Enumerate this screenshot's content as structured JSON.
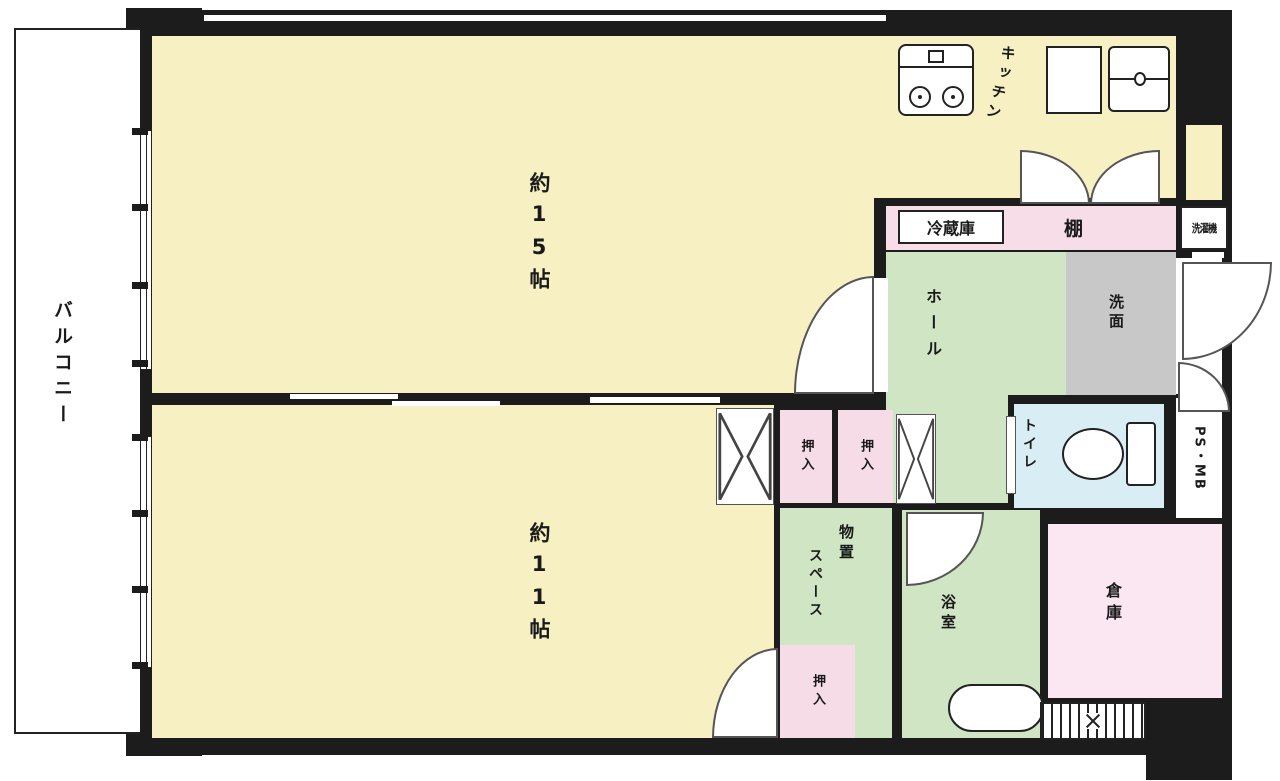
{
  "floor_plan": {
    "balcony_label": "バルコニー",
    "living_label": "約15帖",
    "bedroom_label": "約11帖",
    "kitchen_label": "キッチン",
    "fridge_label": "冷蔵庫",
    "shelf_label": "棚",
    "washer_label": "洗濯機",
    "hall_label": "ホール",
    "washroom_label": "洗面",
    "toilet_label": "トイレ",
    "ps_mb_label": "PS・MB",
    "closet_label": "押入",
    "storage_space_label_line1": "物置",
    "storage_space_label_line2": "スペース",
    "bath_label": "浴室",
    "warehouse_label": "倉庫",
    "icons": {
      "stove": "gas-stove-two-burners",
      "sink": "kitchen-sink-with-faucet",
      "toilet": "toilet-bowl-with-tank",
      "bathtub": "oval-bathtub",
      "doors": "quarter-circle-swing-arcs",
      "vent": "hatched-louver-strip"
    },
    "colors": {
      "wall": "#1c1c1c",
      "room_yellow": "#f6f0c3",
      "room_green": "#cfe5c3",
      "room_gray": "#c8c8c8",
      "room_pink": "#f5dce6",
      "room_pink_light": "#fbe7f2",
      "strip_pink": "#f6dde8",
      "toilet_blue": "#d9edf5"
    }
  }
}
